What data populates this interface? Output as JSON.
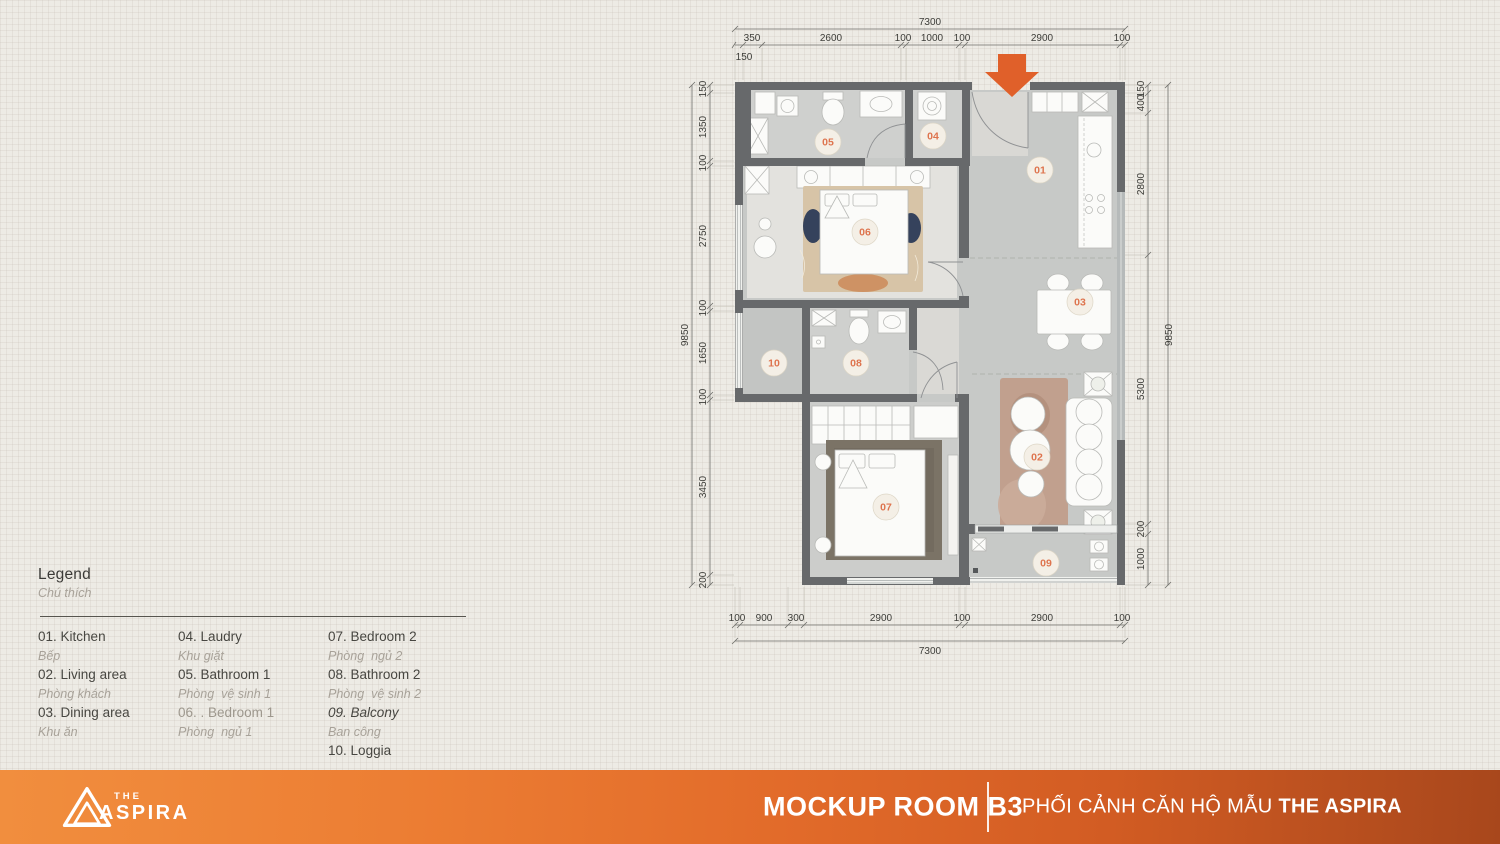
{
  "legend": {
    "title": "Legend",
    "subtitle": "Chú thích",
    "columns": [
      {
        "items": [
          {
            "num": "01.",
            "en": "Kitchen",
            "vi": "Bếp"
          },
          {
            "num": "02.",
            "en": "Living area",
            "vi": "Phòng khách"
          },
          {
            "num": "03.",
            "en": "Dining area",
            "vi": "Khu ăn"
          }
        ]
      },
      {
        "items": [
          {
            "num": "04.",
            "en": "Laudry",
            "vi": "Khu giặt"
          },
          {
            "num": "05.",
            "en": "Bathroom 1",
            "vi": "Phòng  vệ sinh 1"
          },
          {
            "num": "06. .",
            "en": "Bedroom 1",
            "vi": "Phòng  ngủ 1"
          }
        ]
      },
      {
        "items": [
          {
            "num": "07.",
            "en": "Bedroom 2",
            "vi": "Phòng  ngủ 2"
          },
          {
            "num": "08.",
            "en": "Bathroom 2",
            "vi": "Phòng  vệ sinh 2"
          },
          {
            "num": "09.",
            "en": "Balcony",
            "vi": "Ban công"
          },
          {
            "num": "10.",
            "en": "Loggia",
            "vi": ""
          }
        ]
      }
    ]
  },
  "plan": {
    "badges": [
      "01",
      "02",
      "03",
      "04",
      "05",
      "06",
      "07",
      "08",
      "09",
      "10"
    ],
    "dims": {
      "top_total": "7300",
      "top_first": "150",
      "top": [
        "350",
        "2600",
        "100",
        "1000",
        "100",
        "2900",
        "100"
      ],
      "left_total": "9850",
      "left": [
        "150",
        "1350",
        "100",
        "2750",
        "100",
        "1650",
        "100",
        "3450",
        "200"
      ],
      "right_total": "9850",
      "right": [
        "150",
        "400",
        "2800",
        "5300",
        "200",
        "1000"
      ],
      "bottom_total": "7300",
      "bottom": [
        "100",
        "900",
        "300",
        "2900",
        "100",
        "2900",
        "100"
      ]
    }
  },
  "footer": {
    "logo_the": "THE",
    "logo_name": "ASPIRA",
    "room_title": "MOCKUP ROOM B3",
    "caption_normal": "PHỐI CẢNH CĂN HỘ MẪU",
    "caption_bold": "THE ASPIRA"
  },
  "colors": {
    "accent_orange": "#E0602A",
    "badge_number": "#DE744E",
    "wall": "#67696B",
    "footer_gradient_start": "#F18E3E",
    "footer_gradient_end": "#A8471C"
  }
}
